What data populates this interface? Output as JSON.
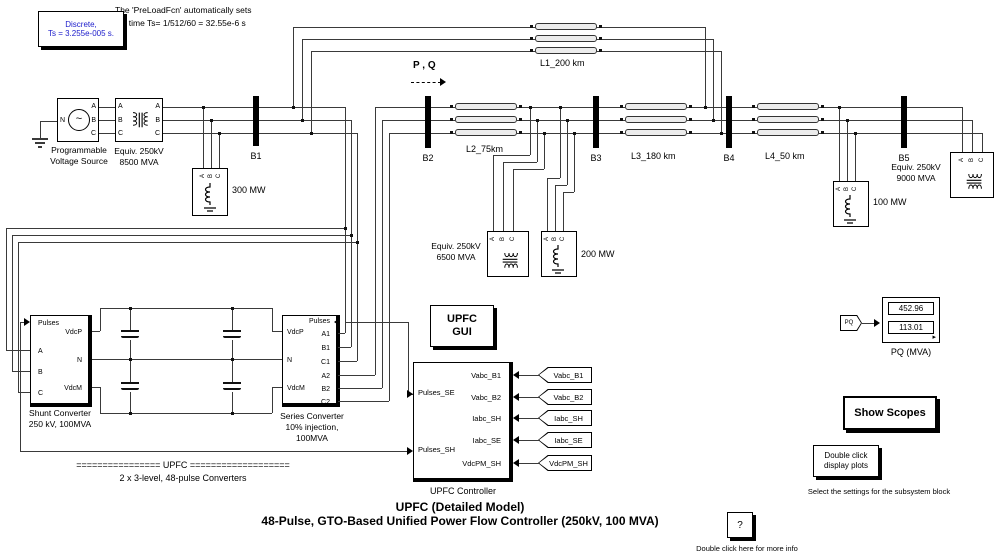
{
  "annotations": {
    "preload_line1": "The 'PreLoadFcn' automatically sets",
    "preload_line2": "sample time Ts= 1/512/60 = 32.55e-6 s",
    "pq_flow": "P , Q",
    "upfc_banner": "================ UPFC ===================",
    "converters_note": "2 x  3-level, 48-pulse Converters",
    "title_line1": "UPFC (Detailed Model)",
    "title_line2": "48-Pulse, GTO-Based Unified Power Flow Controller (250kV, 100 MVA)",
    "settings_caption": "Select the settings for the subsystem block",
    "info_caption": "Double click here for more info"
  },
  "discrete_block": {
    "line1": "Discrete,",
    "line2": "Ts = 3.255e-005 s.",
    "text_color": "#2020cc"
  },
  "power_system": {
    "port_letters": [
      "A",
      "B",
      "C"
    ],
    "neutral_port": "N",
    "source_label_1": "Programmable",
    "source_label_2": "Voltage Source",
    "equiv_left_1": "Equiv. 250kV",
    "equiv_left_2": "8500 MVA",
    "equiv_mid_1": "Equiv. 250kV",
    "equiv_mid_2": "6500 MVA",
    "equiv_right_1": "Equiv. 250kV",
    "equiv_right_2": "9000 MVA",
    "buses": [
      "B1",
      "B2",
      "B3",
      "B4",
      "B5"
    ],
    "lines": [
      "L1_200 km",
      "L2_75km",
      "L3_180 km",
      "L4_50 km"
    ],
    "loads": [
      "300 MW",
      "200 MW",
      "100 MW"
    ]
  },
  "shunt_converter": {
    "name_1": "Shunt Converter",
    "name_2": "250 kV, 100MVA",
    "port_pulses": "Pulses",
    "port_a": "A",
    "port_b": "B",
    "port_c": "C",
    "port_vdcp": "VdcP",
    "port_n": "N",
    "port_vdcm": "VdcM"
  },
  "series_converter": {
    "name_1": "Series Converter",
    "name_2": "10% injection,",
    "name_3": "100MVA",
    "port_pulses": "Pulses",
    "port_vdcp": "VdcP",
    "port_n": "N",
    "port_vdcm": "VdcM",
    "ports_right": [
      "A1",
      "B1",
      "C1",
      "A2",
      "B2",
      "C2"
    ]
  },
  "upfc_gui": {
    "line1": "UPFC",
    "line2": "GUI"
  },
  "controller": {
    "label": "UPFC Controller",
    "outputs": [
      "Pulses_SE",
      "Pulses_SH"
    ],
    "inputs": [
      "Vabc_B1",
      "Vabc_B2",
      "Iabc_SH",
      "Iabc_SE",
      "VdcPM_SH"
    ]
  },
  "signal_tags": [
    "Vabc_B1",
    "Vabc_B2",
    "Iabc_SH",
    "Iabc_SE",
    "VdcPM_SH"
  ],
  "pq_display": {
    "from_tag": "PQ",
    "value_p": "452.96",
    "value_q": "113.01",
    "label": "PQ (MVA)"
  },
  "buttons": {
    "show_scopes": "Show Scopes",
    "display_plots_1": "Double click",
    "display_plots_2": "display plots",
    "info": "?"
  }
}
